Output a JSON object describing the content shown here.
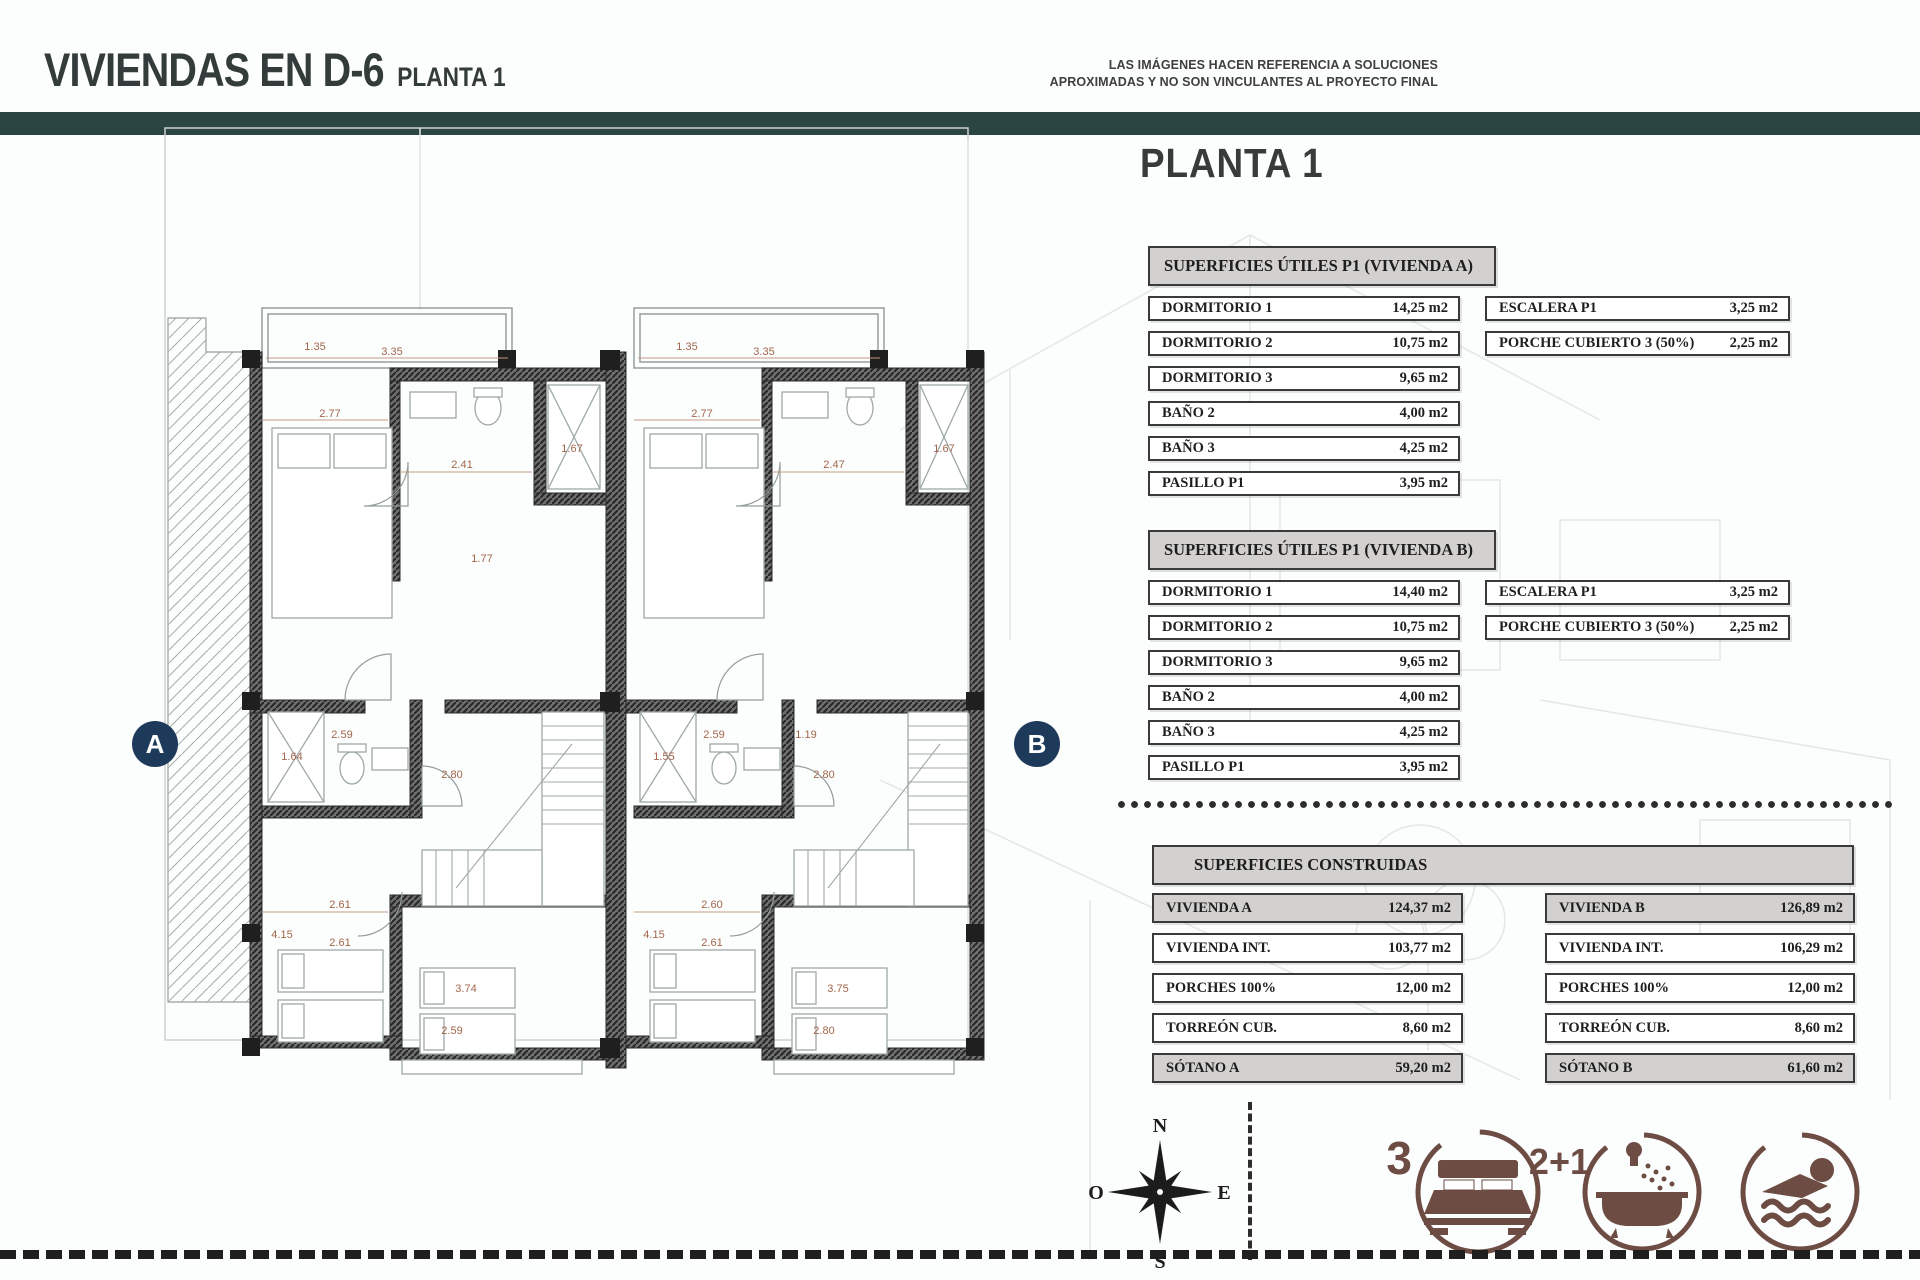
{
  "header": {
    "title": "VIVIENDAS EN D-6",
    "subtitle": "PLANTA 1",
    "disclaimer_line1": "LAS IMÁGENES HACEN REFERENCIA A SOLUCIONES",
    "disclaimer_line2": "APROXIMADAS Y NO SON VINCULANTES AL PROYECTO FINAL"
  },
  "panel": {
    "heading": "PLANTA 1",
    "useful_a": {
      "title": "SUPERFICIES ÚTILES P1 (VIVIENDA A)",
      "rows": [
        {
          "label": "DORMITORIO 1",
          "value": "14,25 m2"
        },
        {
          "label": "DORMITORIO 2",
          "value": "10,75 m2"
        },
        {
          "label": "DORMITORIO 3",
          "value": "9,65 m2"
        },
        {
          "label": "BAÑO 2",
          "value": "4,00 m2"
        },
        {
          "label": "BAÑO 3",
          "value": "4,25 m2"
        },
        {
          "label": "PASILLO P1",
          "value": "3,95 m2"
        }
      ],
      "side_rows": [
        {
          "label": "ESCALERA P1",
          "value": "3,25 m2"
        },
        {
          "label": "PORCHE CUBIERTO 3 (50%)",
          "value": "2,25 m2"
        }
      ]
    },
    "useful_b": {
      "title": "SUPERFICIES ÚTILES P1 (VIVIENDA B)",
      "rows": [
        {
          "label": "DORMITORIO 1",
          "value": "14,40 m2"
        },
        {
          "label": "DORMITORIO 2",
          "value": "10,75 m2"
        },
        {
          "label": "DORMITORIO 3",
          "value": "9,65 m2"
        },
        {
          "label": "BAÑO 2",
          "value": "4,00 m2"
        },
        {
          "label": "BAÑO 3",
          "value": "4,25 m2"
        },
        {
          "label": "PASILLO P1",
          "value": "3,95 m2"
        }
      ],
      "side_rows": [
        {
          "label": "ESCALERA P1",
          "value": "3,25 m2"
        },
        {
          "label": "PORCHE CUBIERTO 3 (50%)",
          "value": "2,25 m2"
        }
      ]
    },
    "built": {
      "title": "SUPERFICIES CONSTRUIDAS",
      "col_a": [
        {
          "label": "VIVIENDA A",
          "value": "124,37 m2",
          "gray": true
        },
        {
          "label": "VIVIENDA INT.",
          "value": "103,77 m2"
        },
        {
          "label": "PORCHES 100%",
          "value": "12,00 m2"
        },
        {
          "label": "TORREÓN CUB.",
          "value": "8,60 m2"
        },
        {
          "label": "SÓTANO A",
          "value": "59,20 m2",
          "gray": true
        }
      ],
      "col_b": [
        {
          "label": "VIVIENDA B",
          "value": "126,89 m2",
          "gray": true
        },
        {
          "label": "VIVIENDA INT.",
          "value": "106,29 m2"
        },
        {
          "label": "PORCHES 100%",
          "value": "12,00 m2"
        },
        {
          "label": "TORREÓN CUB.",
          "value": "8,60 m2"
        },
        {
          "label": "SÓTANO B",
          "value": "61,60 m2",
          "gray": true
        }
      ]
    }
  },
  "plan": {
    "marker_a": "A",
    "marker_b": "B",
    "compass": {
      "n": "N",
      "e": "E",
      "s": "S",
      "o": "O"
    },
    "dims_a": [
      "1.35",
      "3.35",
      "2.77",
      "2.41",
      "1.67",
      "1.77",
      "2.59",
      "1.64",
      "2.80",
      "2.61",
      "4.15",
      "3.74",
      "2.61",
      "2.59"
    ],
    "dims_b": [
      "1.35",
      "3.35",
      "2.77",
      "2.47",
      "1.67",
      "2.59",
      "1.19",
      "1.55",
      "2.80",
      "2.60",
      "4.15",
      "3.75",
      "2.61",
      "2.80"
    ]
  },
  "legend": {
    "bedrooms": "3",
    "bathrooms": "2+1"
  },
  "colors": {
    "accent_teal": "#2b4642",
    "marker_navy": "#1d3a5a",
    "icon_brown": "#6d4c44",
    "dim_text": "#a2664c"
  }
}
